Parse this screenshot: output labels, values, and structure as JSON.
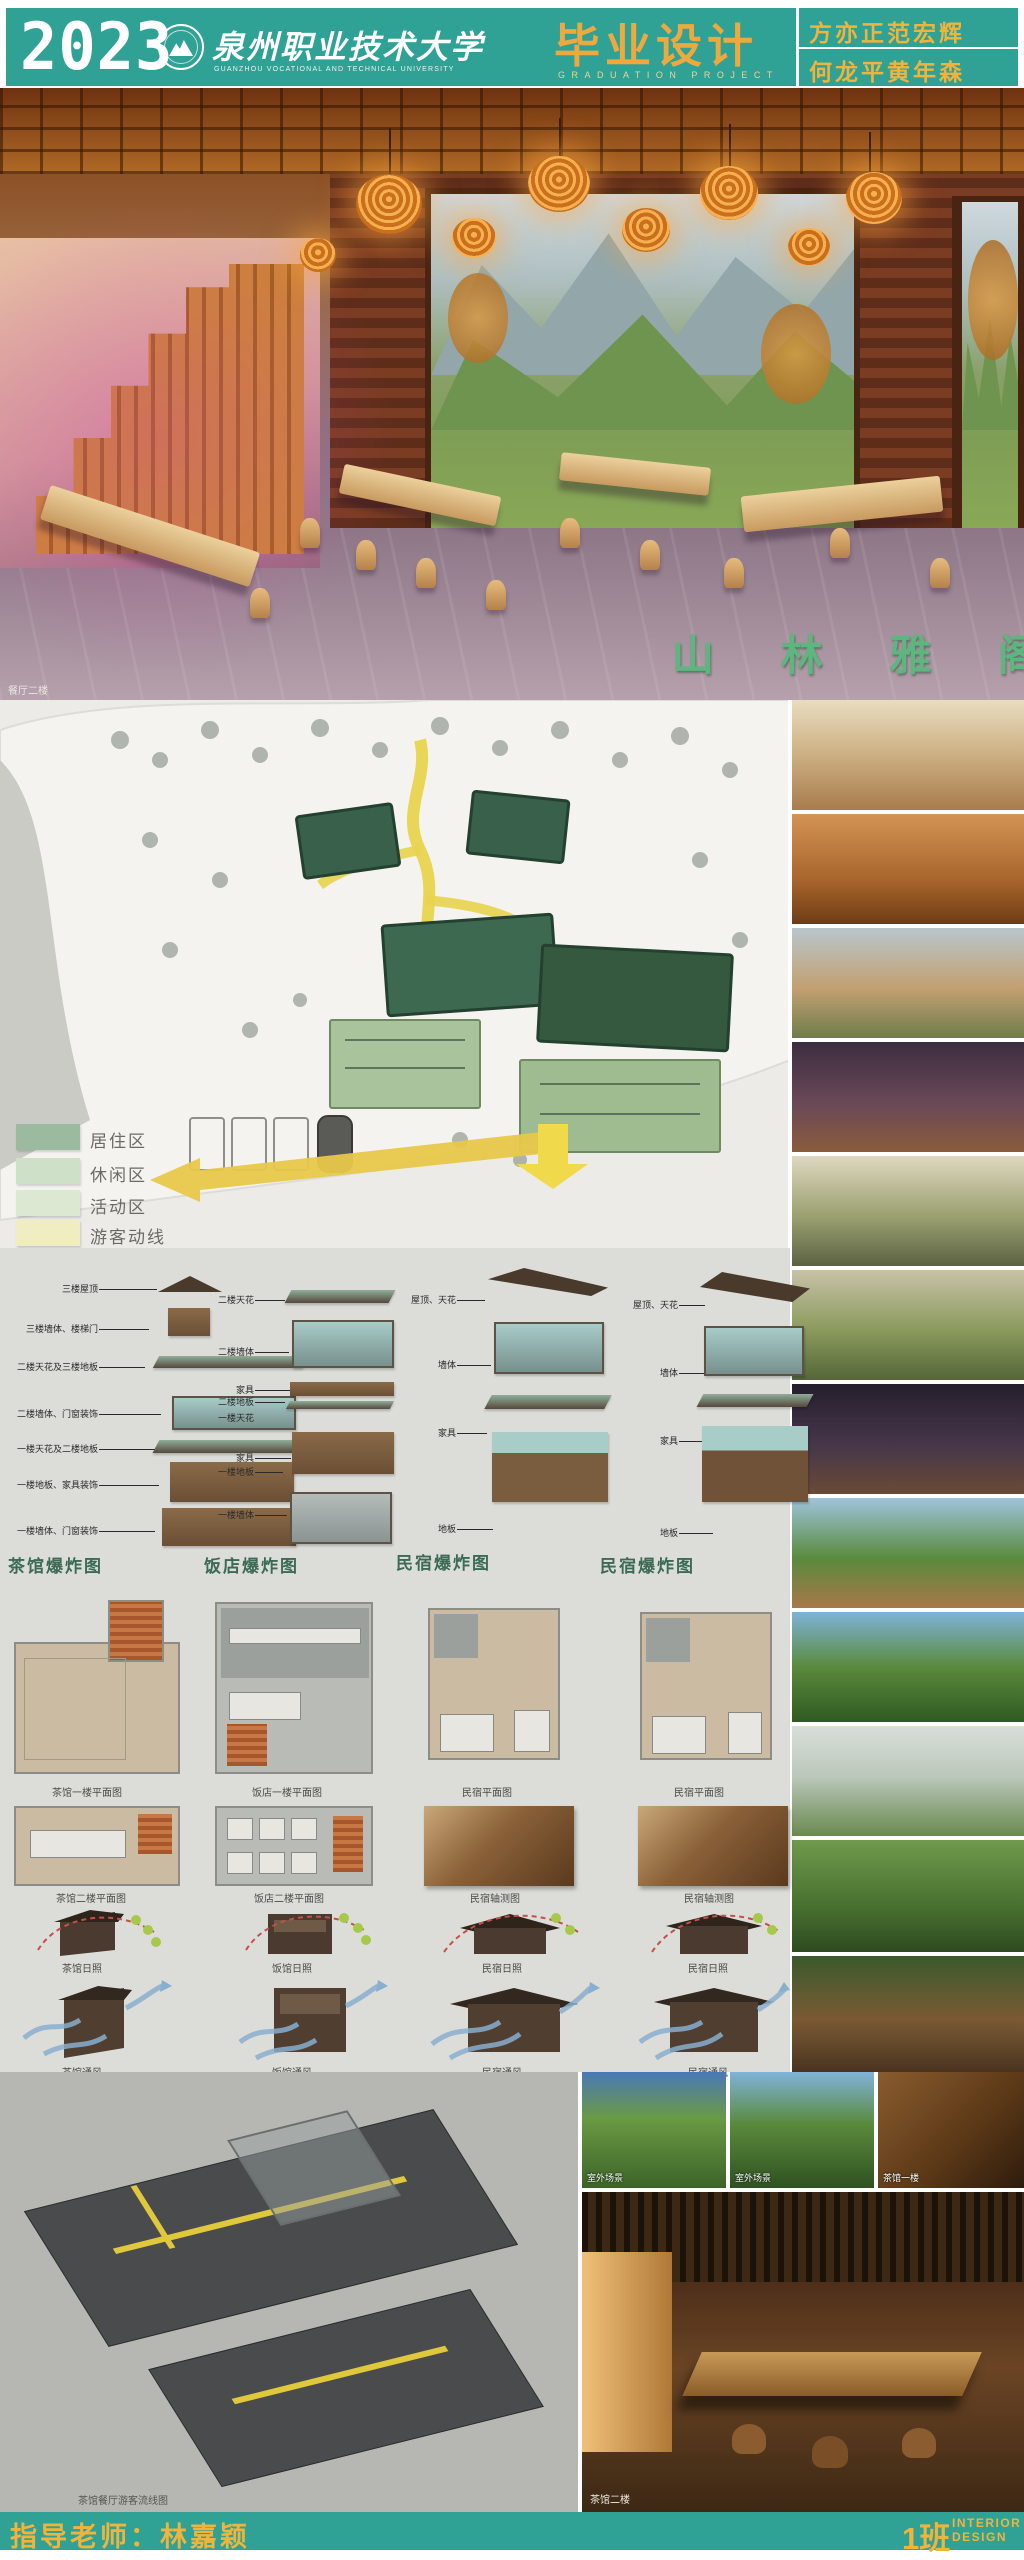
{
  "header": {
    "year": "2023",
    "university_cn": "泉州职业技术大学",
    "university_en": "GUANZHOU VOCATIONAL AND TECHNICAL UNIVERSITY",
    "project_cn": "毕业设计",
    "project_en": "GRADUATION PROJECT",
    "authors_line1": "方亦正范宏辉",
    "authors_line2": "何龙平黄年森"
  },
  "hero": {
    "watermark": "山林雅阁",
    "caption": "餐厅二楼"
  },
  "site_plan": {
    "caption": "游客动线、功能分区图",
    "legend": [
      {
        "label": "居住区",
        "color": "#9cbaa0"
      },
      {
        "label": "休闲区",
        "color": "#cfe0c8"
      },
      {
        "label": "活动区",
        "color": "#dde8d2"
      },
      {
        "label": "游客动线",
        "color": "#f0eec0"
      }
    ]
  },
  "exploded": {
    "columns": [
      {
        "title": "茶馆爆炸图",
        "labels": [
          "三楼屋顶",
          "三楼墙体、楼梯门",
          "二楼天花及三楼地板",
          "二楼墙体、门窗装饰",
          "一楼天花及二楼地板",
          "一楼地板、家具装饰",
          "一楼墙体、门窗装饰"
        ]
      },
      {
        "title": "饭店爆炸图",
        "labels": [
          "二楼天花",
          "二楼墙体",
          "家具",
          "二楼地板",
          "一楼天花",
          "家具",
          "一楼地板",
          "一楼墙体"
        ]
      },
      {
        "title": "民宿爆炸图",
        "labels": [
          "屋顶、天花",
          "墙体",
          "家具",
          "地板"
        ]
      },
      {
        "title": "民宿爆炸图",
        "labels": [
          "屋顶、天花",
          "墙体",
          "家具",
          "地板"
        ]
      }
    ]
  },
  "plans": {
    "row1": [
      "茶馆一楼平面图",
      "饭店一楼平面图",
      "民宿平面图",
      "民宿平面图"
    ],
    "row2": [
      "茶馆二楼平面图",
      "饭店二楼平面图",
      "民宿轴测图",
      "民宿轴测图"
    ]
  },
  "analysis": {
    "sun": [
      "茶馆日照",
      "饭馆日照",
      "民宿日照",
      "民宿日照"
    ],
    "wind": [
      "茶馆通风",
      "饭馆通风",
      "民宿通风",
      "民宿通风"
    ]
  },
  "bottom": {
    "model_caption": "茶馆餐厅游客流线图",
    "thumb_labels": [
      "室外场景",
      "室外场景",
      "茶馆一楼"
    ],
    "photo_caption": "茶馆二楼"
  },
  "footer": {
    "advisor": "指导老师：林嘉颖",
    "class_cn": "1班",
    "class_en_line1": "INTERIOR",
    "class_en_line2": "DESIGN"
  },
  "colors": {
    "teal": "#2fa195",
    "accent_yellow": "#f0b43c",
    "title_orange": "#eda93e",
    "watermark_green": "#5fb57f",
    "section_title_green": "#3c6b55",
    "path_yellow": "#e8d44d",
    "legend_residential": "#9cbaa0",
    "legend_leisure": "#cfe0c8",
    "legend_activity": "#dde8d2",
    "legend_route": "#f0eec0"
  }
}
